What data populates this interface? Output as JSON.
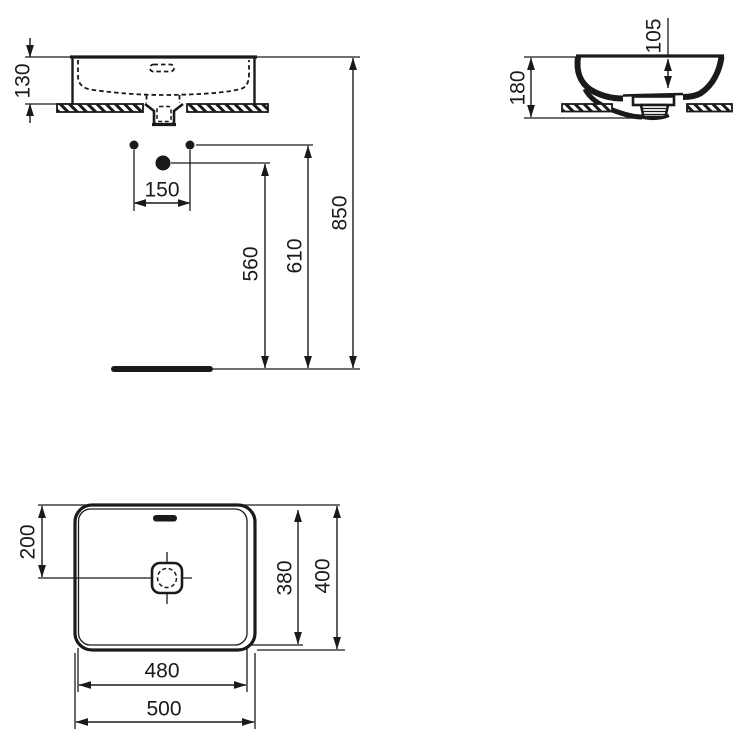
{
  "drawing": {
    "front_view": {
      "basin_height": "130",
      "hole_spacing": "150",
      "drain_leader_height": "560",
      "hole_leader_height": "610",
      "rim_mount_height": "850"
    },
    "side_view": {
      "overall_height": "180",
      "bowl_depth": "105"
    },
    "plan_view": {
      "drain_center_offset": "200",
      "inner_depth": "380",
      "overall_depth": "400",
      "inner_width": "480",
      "overall_width": "500"
    },
    "colors": {
      "line": "#1a1a1a",
      "background": "#ffffff"
    }
  }
}
